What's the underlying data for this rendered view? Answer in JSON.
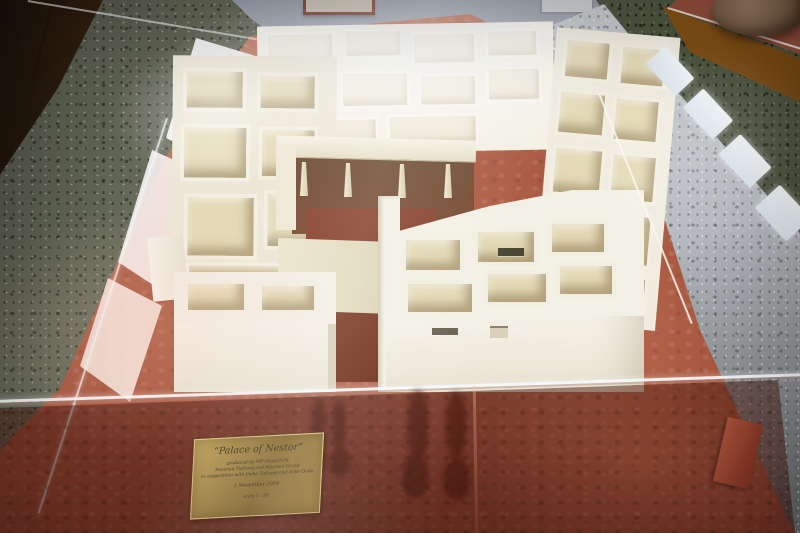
{
  "photo": {
    "subject": "Museum display case with a white architectural scale model of the Palace of Nestor on red fabric",
    "objects": [
      "palace-model",
      "display-case",
      "brass-plaque",
      "ceramic-pot-on-pedestal",
      "framed-picture",
      "wooden-cabinet",
      "terrazzo-floor",
      "window-reflections",
      "visitor-reflection"
    ],
    "plaque": {
      "title": "“Palace of Nestor”",
      "line1": "produced by MP Maastricht",
      "line2": "Maarten Tielrooij and Maarten Grond",
      "line3": "in cooperation with Ineke Tielrooij and Anke Oude",
      "date": "1 November 2004",
      "scale": "scale 1 : 50"
    },
    "colors": {
      "red_base": "#a8573f",
      "red_base_dark": "#6e2a1a",
      "model_white": "#f2efe2",
      "model_tan": "#ddd2ac",
      "megaron_floor": "#8a4530",
      "plaque_brass": "#8f7236",
      "plaque_text": "#3e3420",
      "terrazzo_left": "#7f8470",
      "terrazzo_right": "#b5b9be",
      "terrazzo_dark_green": "#4a533d",
      "wall": "#98a0ac",
      "cabinet_wood": "#7c5226",
      "pedestal_wood": "#9a5f1d"
    }
  }
}
